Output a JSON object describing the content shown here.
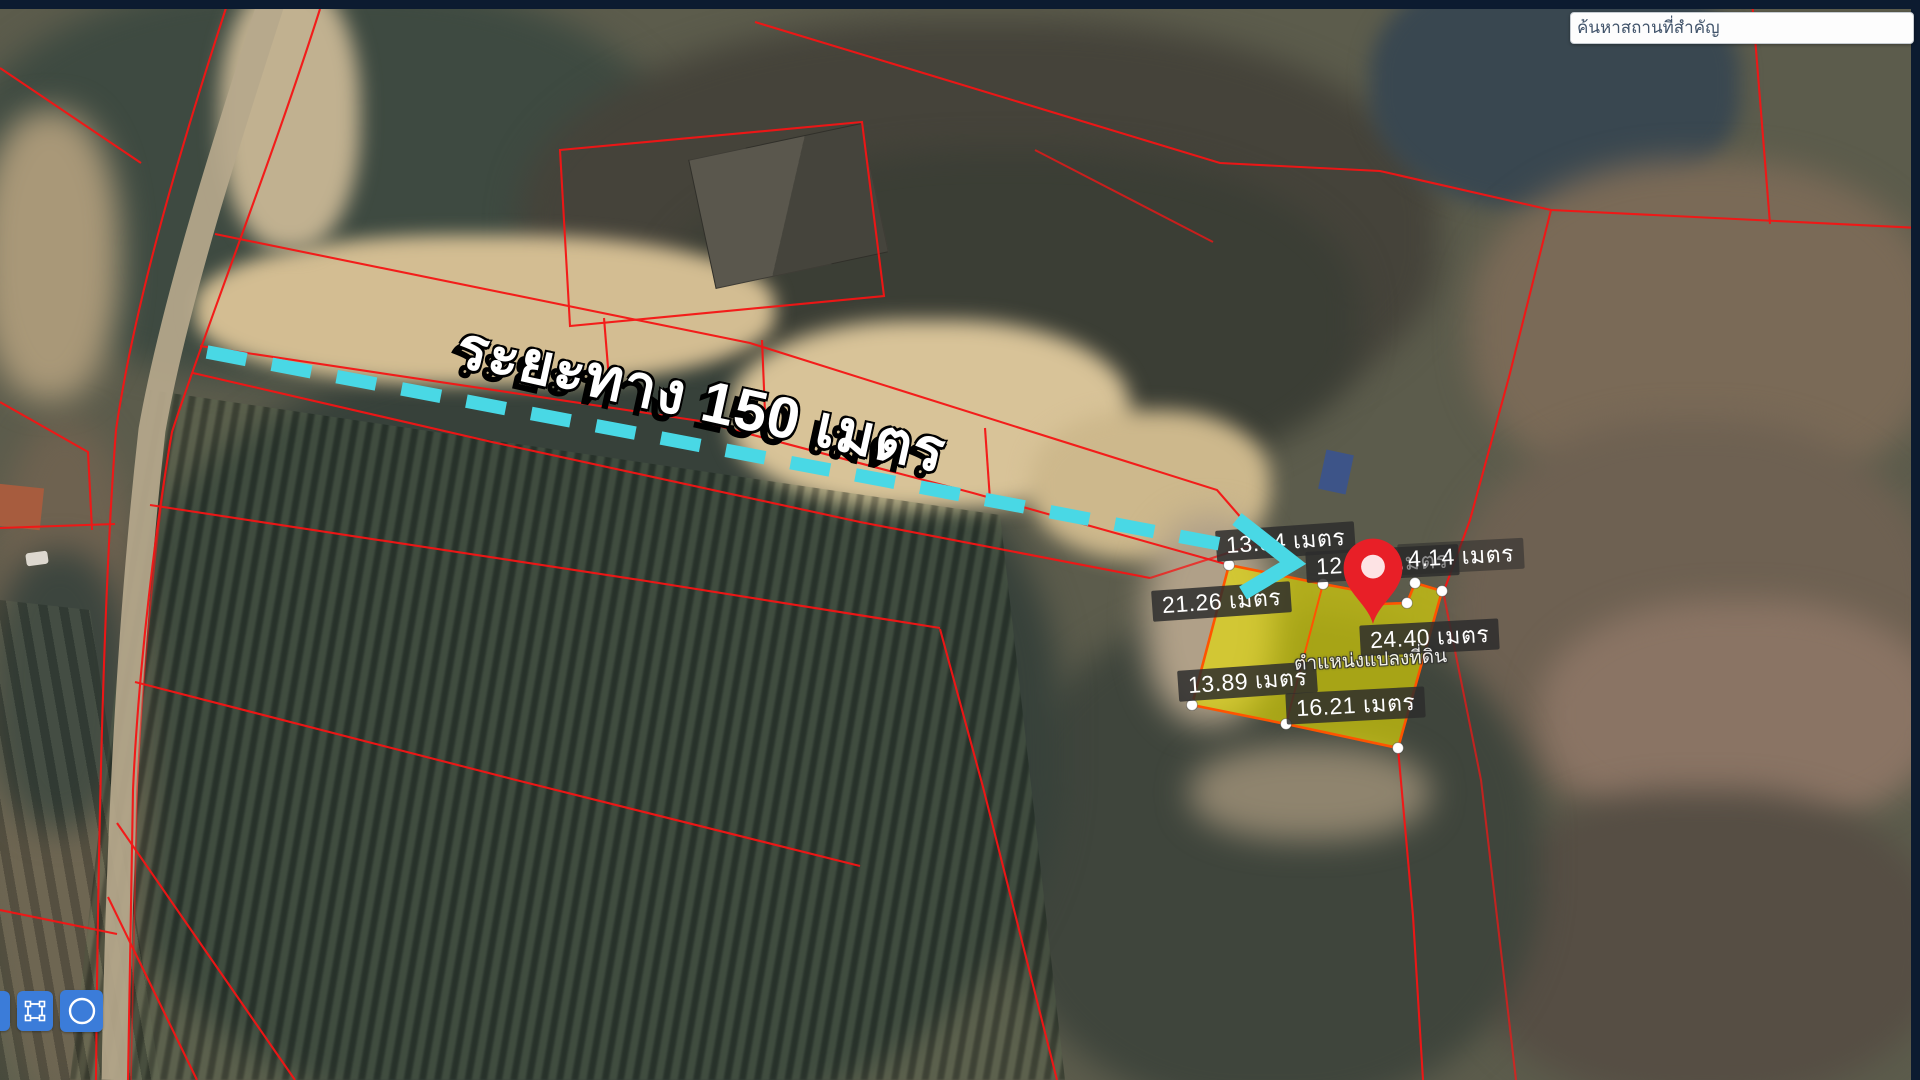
{
  "search": {
    "placeholder": "ค้นหาสถานที่สำคัญ"
  },
  "annotation": {
    "distance_label": "ระยะทาง 150 เมตร",
    "distance_value": "150",
    "unit": "เมตร"
  },
  "parcel": {
    "position_label": "ตำแหน่งแปลงที่ดิน",
    "measurements": [
      {
        "text": "13.84 เมตร"
      },
      {
        "text": "12.663 เมตร"
      },
      {
        "text": "4.14 เมตร"
      },
      {
        "text": "21.26 เมตร"
      },
      {
        "text": "24.40 เมตร"
      },
      {
        "text": "13.89 เมตร"
      },
      {
        "text": "16.21 เมตร"
      }
    ]
  },
  "toolbar": {
    "icons": [
      "draw-tool-partial-icon",
      "draw-rectangle-icon",
      "draw-circle-icon"
    ]
  },
  "icons": [
    "location-pin-icon",
    "distance-arrow"
  ],
  "colors": {
    "navy_chrome": "#0c1b30",
    "cadastral_red": "#f51515",
    "parcel_fill": "#e6de00",
    "parcel_stroke": "#ff5400",
    "arrow_cyan": "#49d8e5",
    "button_blue": "#3b7cd9",
    "label_bg": "rgba(44,44,44,0.84)"
  }
}
